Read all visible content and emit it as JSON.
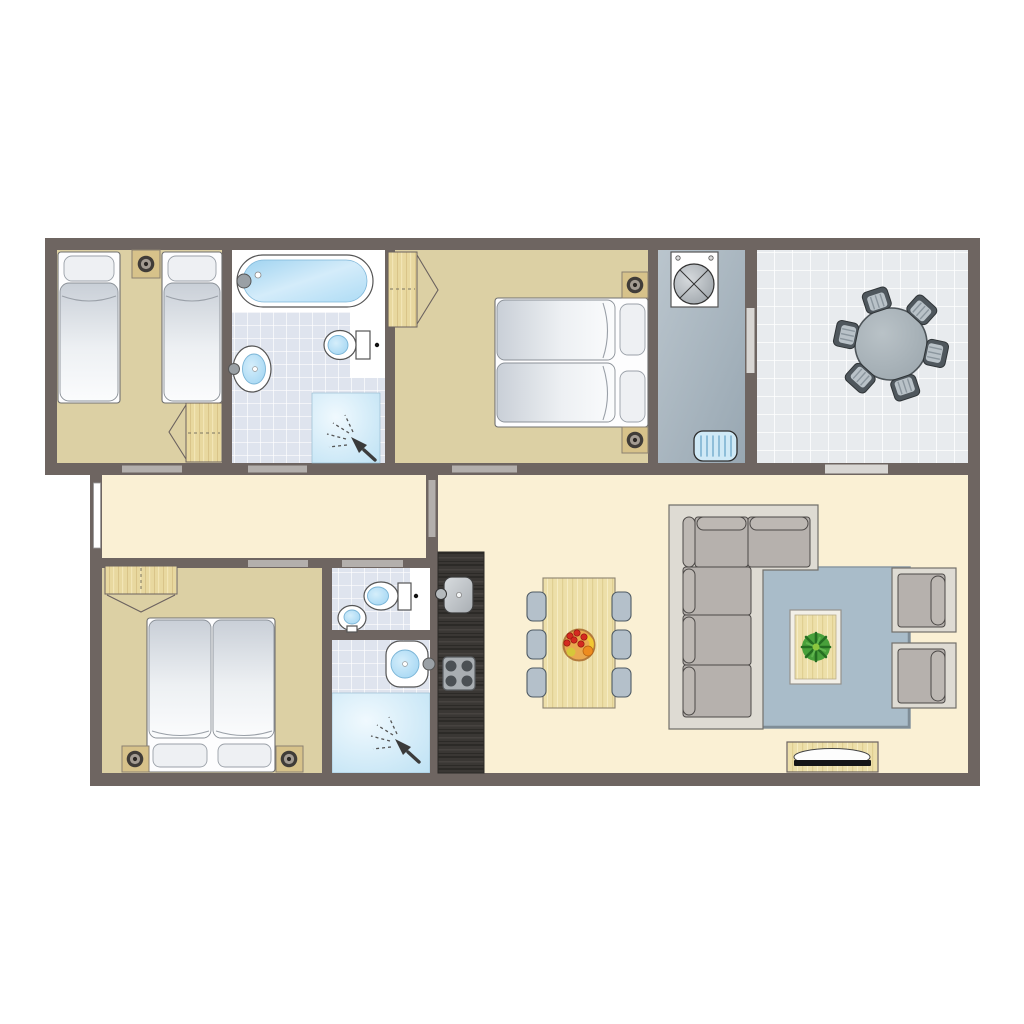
{
  "meta": {
    "title": "Holiday home floor plan, top-down 2D drawing, no text labels",
    "type": "architectural-floor-plan",
    "background": "#ffffff"
  },
  "palette": {
    "wall": "#6e6561",
    "door_threshold": "#b3afac",
    "floor_cream": "#faf0d4",
    "floor_tan": "#dcd0a4",
    "bath_tile": "#dfe4ee",
    "tile_grout": "#ffffff",
    "utility_floor": "#a9b6c0",
    "terrace_tile": "#e8ebee",
    "shower_blue": "#bfe2f4",
    "water_blue": "#aedcf5",
    "wood_light": "#e8d89f",
    "wood_dark": "#3a3734",
    "sofa_grey": "#b6b1ad",
    "sofa_frame": "#dedbd3",
    "rug_blue": "#a9bcc9",
    "dining_chair": "#b4c0ca",
    "outdoor_chair": "#4f575d",
    "appliance_white": "#ffffff"
  },
  "rooms": [
    {
      "id": "bedroom-twin",
      "label": "Twin bedroom with two single beds, shared bedside table with lamp and a wardrobe"
    },
    {
      "id": "bathroom-main",
      "label": "Bathroom with bathtub, washbasin, toilet and corner shower"
    },
    {
      "id": "bedroom-double-top",
      "label": "Double bedroom with double bed, two bedside lamps and a wardrobe"
    },
    {
      "id": "utility-room",
      "label": "Utility room with washing machine and doormat, door to terrace"
    },
    {
      "id": "terrace",
      "label": "Tiled terrace with round garden table and six garden chairs"
    },
    {
      "id": "hallway",
      "label": "Hallway with window"
    },
    {
      "id": "bedroom-double-bottom",
      "label": "Double bedroom with double bed, two bedside lamps and a wardrobe"
    },
    {
      "id": "wc",
      "label": "Separate WC with toilet and hand basin"
    },
    {
      "id": "shower-room",
      "label": "Shower room with washbasin and shower"
    },
    {
      "id": "kitchen",
      "label": "Kitchen counter with sink and four-ring hob"
    },
    {
      "id": "living-dining",
      "label": "Living and dining room with dining table, six chairs, fruit bowl, corner sofa, rug, coffee table with plant, two armchairs and TV cabinet"
    }
  ],
  "furniture_icons": [
    "single-bed-icon",
    "double-bed-icon",
    "pillow-icon",
    "bedside-lamp-icon",
    "wardrobe-icon",
    "bathtub-icon",
    "washbasin-icon",
    "toilet-icon",
    "shower-head-icon",
    "washing-machine-icon",
    "doormat-icon",
    "round-table-icon",
    "garden-chair-icon",
    "dining-table-icon",
    "dining-chair-icon",
    "fruit-bowl-icon",
    "corner-sofa-icon",
    "rug-icon",
    "coffee-table-icon",
    "plant-icon",
    "armchair-icon",
    "tv-cabinet-icon",
    "kitchen-sink-icon",
    "hob-icon",
    "door-threshold-icon",
    "window-icon"
  ],
  "counts": {
    "bedrooms": 3,
    "bathrooms": 2,
    "separate_wc": 1,
    "single_beds": 2,
    "double_beds": 2,
    "dining_chairs": 6,
    "garden_chairs": 6,
    "armchairs": 2
  }
}
